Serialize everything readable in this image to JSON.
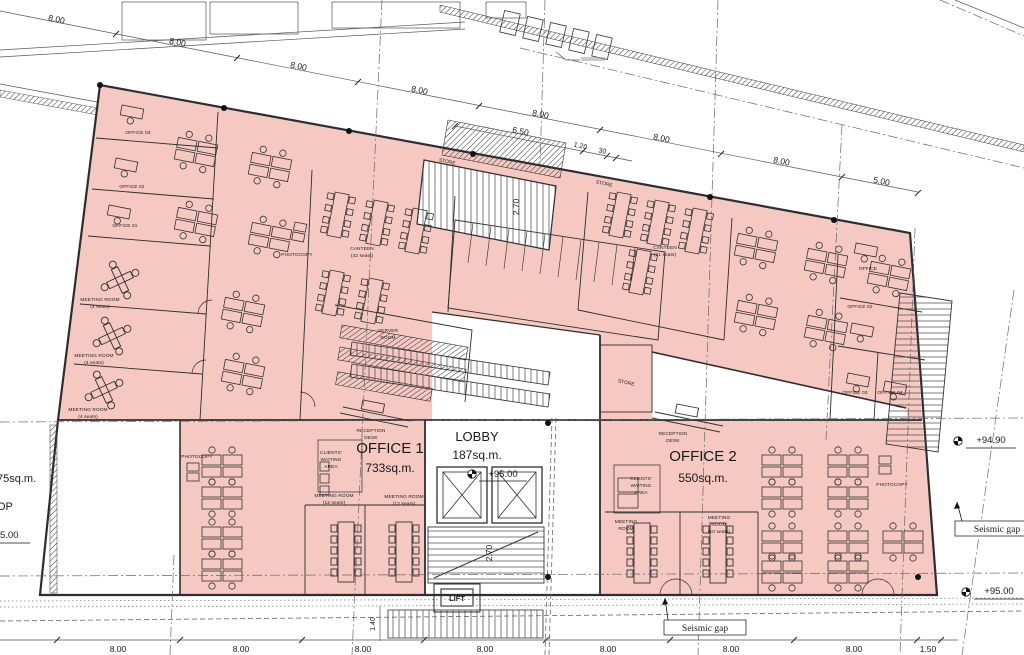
{
  "drawing": {
    "type": "architectural-floor-plan"
  },
  "colors": {
    "highlight": "#f5c8c2",
    "wall": "#2e2e2e",
    "line": "#555555",
    "text": "#1a1a1a"
  },
  "dims": {
    "t1": "8.00",
    "t2": "8.00",
    "t3": "8.00",
    "t4": "8.00",
    "t5": "8.00",
    "t6": "8.00",
    "t7": "8.00",
    "t8": "5.00",
    "e1": "6.50",
    "e2": "1.20",
    "e3": "30",
    "b1": "8.00",
    "b2": "8.00",
    "b3": "8.00",
    "b4": "8.00",
    "b5": "8.00",
    "b6": "8.00",
    "b7": "8.00",
    "b8": "1.50",
    "v1": "2.70",
    "v2": "2.70",
    "v3": "1.40"
  },
  "levels": {
    "lobby": "+95.00",
    "r1": "+94.90",
    "r2": "+95.00",
    "left": "5.00"
  },
  "rooms": {
    "lobby_name": "LOBBY",
    "lobby_area": "187sq.m.",
    "office1_name": "OFFICE 1",
    "office1_area": "733sq.m.",
    "office2_name": "OFFICE 2",
    "office2_area": "550sq.m.",
    "left_area": "75sq.m.",
    "left_name": "OP",
    "office01": "OFFICE 01",
    "office02": "OFFICE 02",
    "office03": "OFFICE 03",
    "r_office": "OFFICE",
    "r_office02": "OFFICE 02",
    "r_office03": "OFFICE 03",
    "r_office04": "OFFICE 04",
    "meeting": "MEETING ROOM",
    "meeting_w1": "MEETING",
    "meeting_w2": "ROOM",
    "seats4": "(4 seats)",
    "seats12": "(12 seats)",
    "seats10": "(10 seats)",
    "canteen": "CANTEEN",
    "seats42": "(42 seats)",
    "seats21": "(21 seats)",
    "store": "STORE",
    "server_w1": "SERVER",
    "server_w2": "ROOM",
    "photocopy": "PHOTOCOPY",
    "reception_w1": "RECEPTION",
    "reception_w2": "DESK",
    "clients_w1": "CLIENTS'",
    "clients_w2": "WAITING",
    "clients_w3": "AREA",
    "lift": "LIFT"
  },
  "notes": {
    "seismic_gap": "Seismic gap"
  }
}
